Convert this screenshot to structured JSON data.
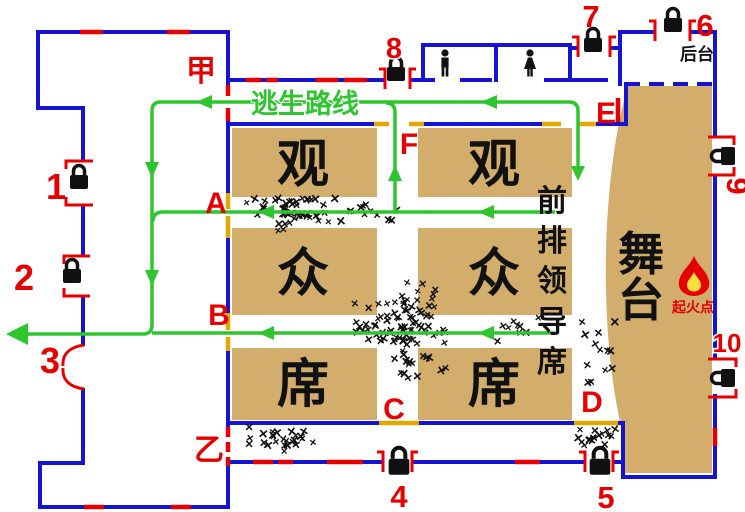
{
  "colors": {
    "wall": "#1414d2",
    "seat": "#d2ad6c",
    "route": "#2ec52e",
    "danger": "#e60000",
    "opening": "#e2a700",
    "crowd": "#111111"
  },
  "escape_route_label": "逃生路线",
  "markers": {
    "jia": "甲",
    "yi": "乙",
    "a": "A",
    "b": "B",
    "c": "C",
    "d": "D",
    "e": "E",
    "f": "F"
  },
  "areas": {
    "backstage": "后台",
    "stage_chars": [
      "舞",
      "台"
    ],
    "fire_point": "起火点",
    "front_row_chars": [
      "前",
      "排",
      "领",
      "导",
      "席"
    ],
    "seating_left_chars": [
      "观",
      "众",
      "席"
    ],
    "seating_right_chars": [
      "观",
      "众",
      "席"
    ]
  },
  "exits": [
    {
      "label": "1",
      "locked": true
    },
    {
      "label": "2",
      "locked": true
    },
    {
      "label": "3",
      "locked": false
    },
    {
      "label": "4",
      "locked": true
    },
    {
      "label": "5",
      "locked": true
    },
    {
      "label": "6",
      "locked": true
    },
    {
      "label": "7",
      "locked": true
    },
    {
      "label": "8",
      "locked": true
    },
    {
      "label": "9",
      "locked": true
    },
    {
      "label": "10",
      "locked": true
    }
  ],
  "crowd_clusters": [
    {
      "name": "aisle-a-left",
      "cx": 292,
      "cy": 216,
      "rx": 60,
      "ry": 21,
      "count": 48
    },
    {
      "name": "aisle-a-mid",
      "cx": 368,
      "cy": 214,
      "rx": 30,
      "ry": 15,
      "count": 10
    },
    {
      "name": "central-jam",
      "cx": 404,
      "cy": 336,
      "rx": 52,
      "ry": 55,
      "count": 95
    },
    {
      "name": "corridor-yi",
      "cx": 285,
      "cy": 444,
      "rx": 45,
      "ry": 14,
      "count": 26
    },
    {
      "name": "front-row-right",
      "cx": 518,
      "cy": 331,
      "rx": 36,
      "ry": 17,
      "count": 9
    },
    {
      "name": "aisle-d-sparse",
      "cx": 600,
      "cy": 356,
      "rx": 24,
      "ry": 46,
      "count": 13
    },
    {
      "name": "exit-d-jam",
      "cx": 596,
      "cy": 441,
      "rx": 24,
      "ry": 13,
      "count": 17
    }
  ]
}
